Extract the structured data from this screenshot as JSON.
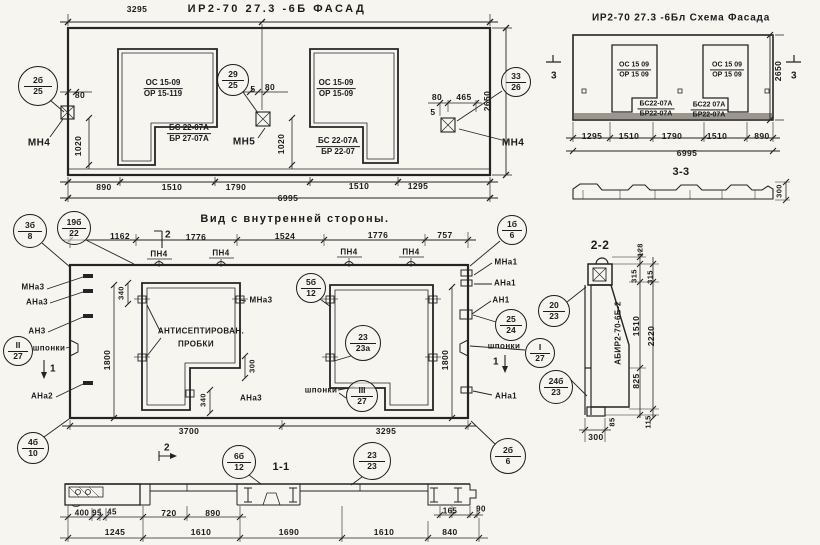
{
  "titles": {
    "facade": "ИР2-70 27.3 -6Б  ФАСАД",
    "schema": "ИР2-70 27.3 -6Бл Схема Фасада",
    "interior": "Вид с внутренней стороны."
  },
  "labels": [
    {
      "n": "facade-dim-3295",
      "t": "3295",
      "x": 137,
      "y": 9
    },
    {
      "n": "facade-dim-80-left",
      "t": "80",
      "x": 80,
      "y": 95
    },
    {
      "n": "facade-dim-1020-left",
      "t": "1020",
      "x": 78,
      "y": 146,
      "rot": 1
    },
    {
      "n": "facade-mark-mn4-left",
      "t": "МН4",
      "x": 39,
      "y": 143,
      "s": 10
    },
    {
      "n": "facade-dim-5-mid",
      "t": "5",
      "x": 253,
      "y": 89
    },
    {
      "n": "facade-dim-80-mid",
      "t": "80",
      "x": 270,
      "y": 87
    },
    {
      "n": "facade-dim-1020-mid",
      "t": "1020",
      "x": 281,
      "y": 144,
      "rot": 1
    },
    {
      "n": "facade-mark-mn5",
      "t": "МН5",
      "x": 244,
      "y": 142,
      "s": 10
    },
    {
      "n": "facade-dim-80-right",
      "t": "80",
      "x": 437,
      "y": 97
    },
    {
      "n": "facade-dim-465",
      "t": "465",
      "x": 464,
      "y": 97
    },
    {
      "n": "facade-dim-5-right",
      "t": "5",
      "x": 433,
      "y": 112
    },
    {
      "n": "facade-dim-2650",
      "t": "2650",
      "x": 487,
      "y": 101,
      "rot": 1
    },
    {
      "n": "facade-mark-mn4-right",
      "t": "МН4",
      "x": 513,
      "y": 143,
      "s": 10
    },
    {
      "n": "facade-dim-890",
      "t": "890",
      "x": 104,
      "y": 187
    },
    {
      "n": "facade-dim-1510-a",
      "t": "1510",
      "x": 172,
      "y": 187
    },
    {
      "n": "facade-dim-1790",
      "t": "1790",
      "x": 236,
      "y": 187
    },
    {
      "n": "facade-dim-1510-b",
      "t": "1510",
      "x": 359,
      "y": 186
    },
    {
      "n": "facade-dim-1295",
      "t": "1295",
      "x": 418,
      "y": 186
    },
    {
      "n": "facade-dim-6995",
      "t": "6995",
      "x": 288,
      "y": 198
    },
    {
      "n": "schema-dim-1295",
      "t": "1295",
      "x": 592,
      "y": 136
    },
    {
      "n": "schema-dim-1510-a",
      "t": "1510",
      "x": 629,
      "y": 136
    },
    {
      "n": "schema-dim-1790",
      "t": "1790",
      "x": 672,
      "y": 136
    },
    {
      "n": "schema-dim-1510-b",
      "t": "1510",
      "x": 717,
      "y": 136
    },
    {
      "n": "schema-dim-890",
      "t": "890",
      "x": 762,
      "y": 136
    },
    {
      "n": "schema-dim-6995",
      "t": "6995",
      "x": 687,
      "y": 153
    },
    {
      "n": "schema-dim-2650",
      "t": "2650",
      "x": 778,
      "y": 71,
      "rot": 1
    },
    {
      "n": "schema-flag-3-left",
      "t": "3",
      "x": 554,
      "y": 76,
      "s": 10
    },
    {
      "n": "schema-flag-3-right",
      "t": "3",
      "x": 794,
      "y": 76,
      "s": 10
    },
    {
      "n": "section33-title",
      "t": "3-3",
      "x": 681,
      "y": 172,
      "s": 11
    },
    {
      "n": "section33-dim-300",
      "t": "300",
      "x": 779,
      "y": 191,
      "rot": 1,
      "s": 7.5
    },
    {
      "n": "interior-dim-1162",
      "t": "1162",
      "x": 120,
      "y": 236
    },
    {
      "n": "interior-flag-2-top",
      "t": "2",
      "x": 168,
      "y": 235,
      "s": 10
    },
    {
      "n": "interior-dim-1776-a",
      "t": "1776",
      "x": 196,
      "y": 237
    },
    {
      "n": "interior-dim-1524",
      "t": "1524",
      "x": 285,
      "y": 236
    },
    {
      "n": "interior-dim-1776-b",
      "t": "1776",
      "x": 378,
      "y": 235
    },
    {
      "n": "interior-dim-757",
      "t": "757",
      "x": 445,
      "y": 235
    },
    {
      "n": "interior-mark-pn4-a",
      "t": "ПН4",
      "x": 159,
      "y": 254,
      "s": 8
    },
    {
      "n": "interior-mark-pn4-b",
      "t": "ПН4",
      "x": 221,
      "y": 253,
      "s": 8
    },
    {
      "n": "interior-mark-pn4-c",
      "t": "ПН4",
      "x": 349,
      "y": 252,
      "s": 8
    },
    {
      "n": "interior-mark-pn4-d",
      "t": "ПН4",
      "x": 411,
      "y": 252,
      "s": 8
    },
    {
      "n": "interior-mark-mna3-left",
      "t": "МНа3",
      "x": 33,
      "y": 287,
      "s": 8
    },
    {
      "n": "interior-mark-ana3-left",
      "t": "АНа3",
      "x": 37,
      "y": 302,
      "s": 8
    },
    {
      "n": "interior-mark-an3",
      "t": "АН3",
      "x": 37,
      "y": 331,
      "s": 8
    },
    {
      "n": "interior-label-shponki-left",
      "t": "шпонки",
      "x": 49,
      "y": 348,
      "s": 8
    },
    {
      "n": "interior-flag-1-left",
      "t": "1",
      "x": 53,
      "y": 369,
      "s": 10
    },
    {
      "n": "interior-mark-ana2",
      "t": "АНа2",
      "x": 42,
      "y": 396,
      "s": 8
    },
    {
      "n": "interior-dim-340-top",
      "t": "340",
      "x": 121,
      "y": 293,
      "rot": 1,
      "s": 7.5
    },
    {
      "n": "interior-mark-mna3-mid",
      "t": "МНа3",
      "x": 261,
      "y": 300,
      "s": 8
    },
    {
      "n": "interior-note-antiseptic-1",
      "t": "АНТИСЕПТИРОВАН.",
      "x": 201,
      "y": 331,
      "s": 8
    },
    {
      "n": "interior-note-antiseptic-2",
      "t": "ПРОБКИ",
      "x": 196,
      "y": 344,
      "s": 8
    },
    {
      "n": "interior-dim-1800-left",
      "t": "1800",
      "x": 107,
      "y": 360,
      "rot": 1
    },
    {
      "n": "interior-dim-300-step",
      "t": "300",
      "x": 252,
      "y": 366,
      "rot": 1,
      "s": 7.5
    },
    {
      "n": "interior-dim-340-bottom",
      "t": "340",
      "x": 203,
      "y": 400,
      "rot": 1,
      "s": 7.5
    },
    {
      "n": "interior-mark-ana3-mid",
      "t": "АНа3",
      "x": 251,
      "y": 398,
      "s": 8
    },
    {
      "n": "interior-label-shponki-mid",
      "t": "шпонки",
      "x": 321,
      "y": 390,
      "s": 8
    },
    {
      "n": "interior-dim-1800-right",
      "t": "1800",
      "x": 445,
      "y": 360,
      "rot": 1
    },
    {
      "n": "interior-mark-mna1-top",
      "t": "МНа1",
      "x": 506,
      "y": 262,
      "s": 8
    },
    {
      "n": "interior-mark-ana1-top",
      "t": "АНа1",
      "x": 505,
      "y": 283,
      "s": 8
    },
    {
      "n": "interior-mark-an1",
      "t": "АН1",
      "x": 501,
      "y": 300,
      "s": 8
    },
    {
      "n": "interior-label-shponki-right",
      "t": "шпонки",
      "x": 504,
      "y": 346,
      "s": 8
    },
    {
      "n": "interior-flag-1-right",
      "t": "1",
      "x": 496,
      "y": 362,
      "s": 10
    },
    {
      "n": "interior-mark-ana1-bottom",
      "t": "АНа1",
      "x": 506,
      "y": 396,
      "s": 8
    },
    {
      "n": "interior-dim-3700",
      "t": "3700",
      "x": 189,
      "y": 431
    },
    {
      "n": "interior-dim-3295",
      "t": "3295",
      "x": 386,
      "y": 431
    },
    {
      "n": "interior-flag-2-bottom",
      "t": "2",
      "x": 167,
      "y": 448,
      "s": 10
    },
    {
      "n": "section11-title",
      "t": "1-1",
      "x": 281,
      "y": 467,
      "s": 11
    },
    {
      "n": "section22-title",
      "t": "2-2",
      "x": 600,
      "y": 245,
      "s": 12
    },
    {
      "n": "section22-dim-128",
      "t": "128",
      "x": 640,
      "y": 250,
      "rot": 1,
      "s": 7.5
    },
    {
      "n": "section22-dim-315-a",
      "t": "315",
      "x": 634,
      "y": 276,
      "rot": 1,
      "s": 7.5
    },
    {
      "n": "section22-dim-315-b",
      "t": "315",
      "x": 650,
      "y": 277,
      "rot": 1,
      "s": 7.5
    },
    {
      "n": "section22-dim-1510",
      "t": "1510",
      "x": 636,
      "y": 326,
      "rot": 1
    },
    {
      "n": "section22-dim-2220",
      "t": "2220",
      "x": 651,
      "y": 336,
      "rot": 1
    },
    {
      "n": "section22-dim-825",
      "t": "825",
      "x": 636,
      "y": 381,
      "rot": 1
    },
    {
      "n": "section22-dim-85",
      "t": "85",
      "x": 612,
      "y": 422,
      "rot": 1,
      "s": 7.5
    },
    {
      "n": "section22-dim-115",
      "t": "115",
      "x": 648,
      "y": 422,
      "rot": 1,
      "s": 7.5
    },
    {
      "n": "section22-dim-300",
      "t": "300",
      "x": 596,
      "y": 437
    },
    {
      "n": "section22-marking",
      "t": "АБИР2-70-6Б-2",
      "x": 618,
      "y": 333,
      "rot": 1,
      "s": 8
    },
    {
      "n": "section11-dim-400",
      "t": "400",
      "x": 82,
      "y": 513,
      "s": 8
    },
    {
      "n": "section11-dim-95",
      "t": "95",
      "x": 97,
      "y": 513,
      "s": 8
    },
    {
      "n": "section11-dim-45",
      "t": "45",
      "x": 112,
      "y": 512,
      "s": 8
    },
    {
      "n": "section11-dim-720",
      "t": "720",
      "x": 169,
      "y": 513
    },
    {
      "n": "section11-dim-890",
      "t": "890",
      "x": 213,
      "y": 513
    },
    {
      "n": "section11-dim-165",
      "t": "165",
      "x": 450,
      "y": 511,
      "s": 8
    },
    {
      "n": "section11-dim-90",
      "t": "90",
      "x": 481,
      "y": 509,
      "s": 8
    },
    {
      "n": "section11-dim-1245",
      "t": "1245",
      "x": 115,
      "y": 532
    },
    {
      "n": "section11-dim-1610-a",
      "t": "1610",
      "x": 201,
      "y": 532
    },
    {
      "n": "section11-dim-1690",
      "t": "1690",
      "x": 289,
      "y": 532
    },
    {
      "n": "section11-dim-1610-b",
      "t": "1610",
      "x": 384,
      "y": 532
    },
    {
      "n": "section11-dim-840",
      "t": "840",
      "x": 450,
      "y": 532
    }
  ],
  "fractions": [
    {
      "n": "facade-window-left-mark",
      "top": "ОС 15-09",
      "bottom": "ОР 15-119",
      "x": 163,
      "y": 89
    },
    {
      "n": "facade-lintel-left-mark",
      "top": "БС 22-07А",
      "bottom": "БР 27-07А",
      "x": 189,
      "y": 134
    },
    {
      "n": "facade-window-right-mark",
      "top": "ОС 15-09",
      "bottom": "ОР 15-09",
      "x": 336,
      "y": 89
    },
    {
      "n": "facade-lintel-right-mark",
      "top": "БС 22-07А",
      "bottom": "БР 22-07",
      "x": 338,
      "y": 147
    },
    {
      "n": "schema-window-left-mark",
      "top": "ОС 15 09",
      "bottom": "ОР 15 09",
      "x": 634,
      "y": 70,
      "s": 7
    },
    {
      "n": "schema-lintel-left-mark",
      "top": "БС22-07А",
      "bottom": "БР22-07А",
      "x": 656,
      "y": 109,
      "s": 7
    },
    {
      "n": "schema-window-right-mark",
      "top": "ОС 15 09",
      "bottom": "ОР 15 09",
      "x": 727,
      "y": 70,
      "s": 7
    },
    {
      "n": "schema-lintel-right-mark",
      "top": "БС22 07А",
      "bottom": "БР22-07А",
      "x": 709,
      "y": 110,
      "s": 7
    }
  ],
  "balloons": [
    {
      "n": "balloon-2b-25",
      "top": "2б",
      "bottom": "25",
      "cx": 38,
      "cy": 86,
      "r": 20
    },
    {
      "n": "balloon-29-25",
      "top": "29",
      "bottom": "25",
      "cx": 233,
      "cy": 80,
      "r": 16
    },
    {
      "n": "balloon-33-26",
      "top": "33",
      "bottom": "26",
      "cx": 516,
      "cy": 82,
      "r": 15
    },
    {
      "n": "balloon-3b-8",
      "top": "3б",
      "bottom": "8",
      "cx": 30,
      "cy": 231,
      "r": 17
    },
    {
      "n": "balloon-19b-22",
      "top": "19б",
      "bottom": "22",
      "cx": 74,
      "cy": 228,
      "r": 17
    },
    {
      "n": "balloon-1b-6",
      "top": "1б",
      "bottom": "6",
      "cx": 512,
      "cy": 230,
      "r": 15
    },
    {
      "n": "balloon-5b-12",
      "top": "5б",
      "bottom": "12",
      "cx": 311,
      "cy": 288,
      "r": 15
    },
    {
      "n": "balloon-roman2-27",
      "top": "II",
      "bottom": "27",
      "cx": 18,
      "cy": 351,
      "r": 15
    },
    {
      "n": "balloon-23-23a",
      "top": "23",
      "bottom": "23а",
      "cx": 363,
      "cy": 343,
      "r": 18
    },
    {
      "n": "balloon-roman3-27",
      "top": "III",
      "bottom": "27",
      "cx": 362,
      "cy": 396,
      "r": 16
    },
    {
      "n": "balloon-25-24",
      "top": "25",
      "bottom": "24",
      "cx": 511,
      "cy": 325,
      "r": 16
    },
    {
      "n": "balloon-roman1-27",
      "top": "I",
      "bottom": "27",
      "cx": 540,
      "cy": 353,
      "r": 15
    },
    {
      "n": "balloon-20-23",
      "top": "20",
      "bottom": "23",
      "cx": 554,
      "cy": 311,
      "r": 16
    },
    {
      "n": "balloon-24b-23",
      "top": "24б",
      "bottom": "23",
      "cx": 556,
      "cy": 387,
      "r": 17
    },
    {
      "n": "balloon-4b-10",
      "top": "4б",
      "bottom": "10",
      "cx": 33,
      "cy": 448,
      "r": 16
    },
    {
      "n": "balloon-6b-12",
      "top": "6б",
      "bottom": "12",
      "cx": 239,
      "cy": 462,
      "r": 17
    },
    {
      "n": "balloon-23-23",
      "top": "23",
      "bottom": "23",
      "cx": 372,
      "cy": 461,
      "r": 19
    },
    {
      "n": "balloon-2b-6",
      "top": "2б",
      "bottom": "6",
      "cx": 508,
      "cy": 456,
      "r": 18
    }
  ]
}
